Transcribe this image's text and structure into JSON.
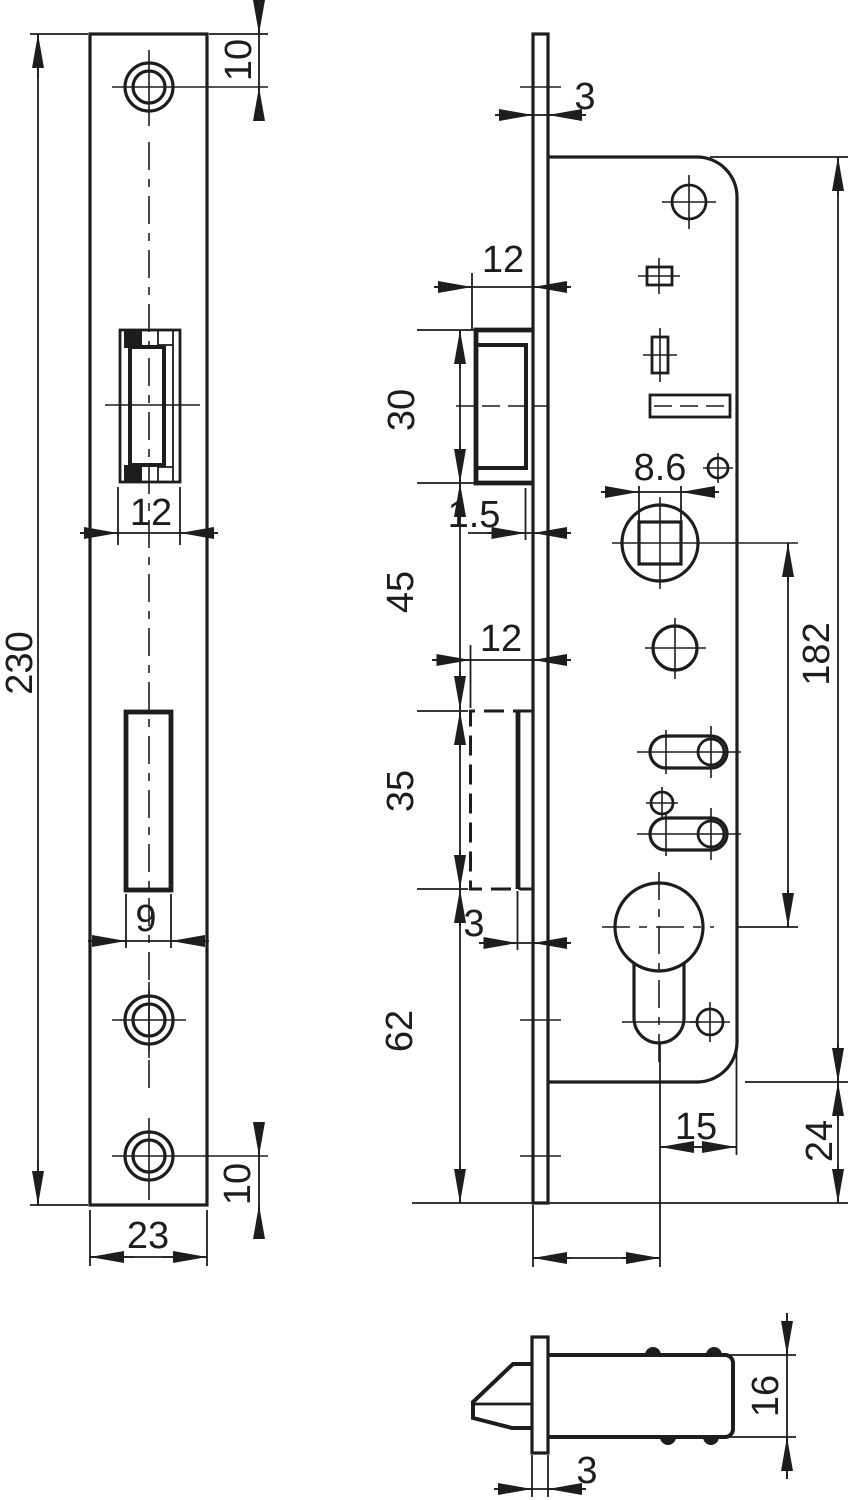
{
  "drawing": {
    "type": "technical-dimension-drawing",
    "subject": "mortise-lock",
    "background": "#ffffff",
    "line_color": "#1d1d1b",
    "views": [
      "faceplate-front-view",
      "lock-side-view",
      "latch-detail-view"
    ]
  },
  "labels": {
    "faceplate_height": "230",
    "faceplate_width": "23",
    "faceplate_top_hole_offset": "10",
    "faceplate_bottom_hole_offset": "10",
    "latch_cutout_width": "12",
    "deadbolt_cutout_width": "9",
    "faceplate_thickness_top": "3",
    "latch_protrusion": "12",
    "latch_height": "30",
    "latch_lip": "1.5",
    "latch_to_deadbolt": "45",
    "deadbolt_throw": "12",
    "deadbolt_height": "35",
    "deadbolt_protrusion": "3",
    "deadbolt_to_bottom": "62",
    "follower_square_size": "8.6",
    "case_height": "182",
    "case_to_plate_end": "24",
    "cylinder_to_case_edge": "15",
    "latch_case_depth": "16",
    "faceplate_thickness_detail": "3"
  }
}
